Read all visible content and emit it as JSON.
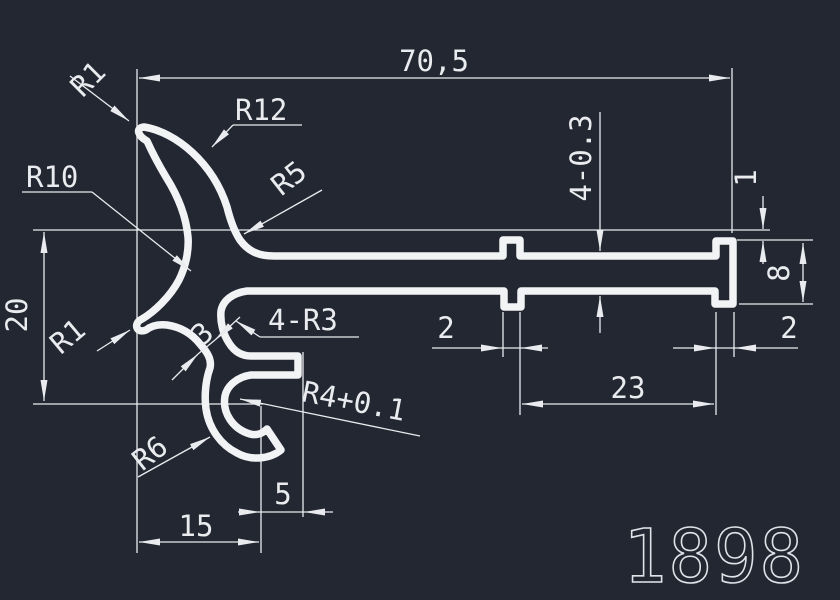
{
  "drawing": {
    "part_number": "1898",
    "colors": {
      "background": "#222731",
      "line": "#e9ebee"
    },
    "dimensions": {
      "overall_width": "70,5",
      "left_height": "20",
      "right_step": "1",
      "end_height": "8",
      "bar_thickness": "4-0.3",
      "left_tooth_width": "2",
      "teeth_spacing": "23",
      "end_block_width": "2",
      "hook_horizontal": "15",
      "finger_gap": "5",
      "wall_thickness": "3"
    },
    "radii": {
      "top_tip": "R1",
      "outer_arc": "R12",
      "inner_arc": "R10",
      "bar_fillet": "R5",
      "bottom_tip": "R1",
      "corner_fillets": "4-R3",
      "hook_inner": "R4+0.1",
      "hook_outer": "R6"
    }
  }
}
